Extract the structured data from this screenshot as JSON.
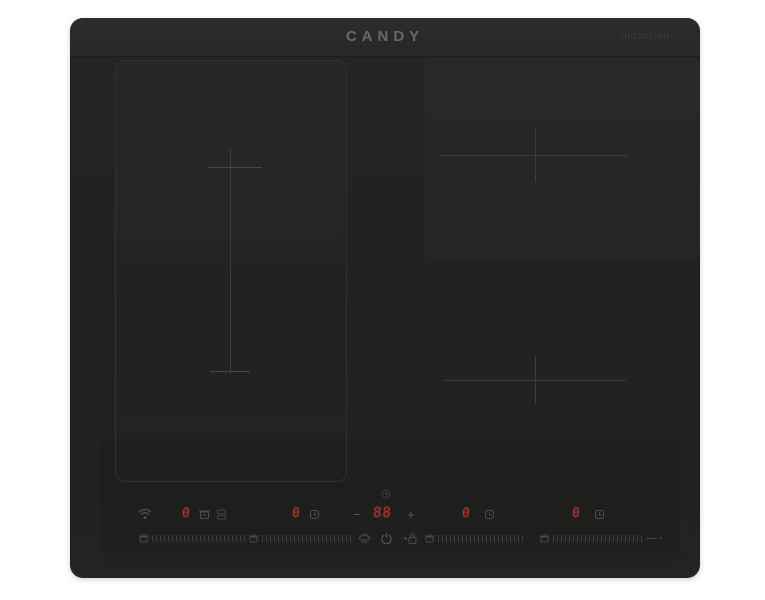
{
  "brand": {
    "logo_text": "CANDY",
    "tagline": "induction"
  },
  "control_panel": {
    "zones": [
      {
        "name": "left-front",
        "level": "0"
      },
      {
        "name": "left-rear",
        "level": "0"
      },
      {
        "name": "right-rear",
        "level": "0"
      },
      {
        "name": "right-front",
        "level": "0"
      }
    ],
    "timer": {
      "value": "88",
      "minus_label": "−",
      "plus_label": "+"
    },
    "icons": {
      "wifi": "wifi-icon",
      "pot_detect": "pot-icon",
      "bridge_zone": "bridge-zone-icon",
      "timer_clock": "clock-icon",
      "special_functions": "chef-hat-icon",
      "power": "power-icon",
      "child_lock": "lock-icon",
      "zone_slider": "pan-icon"
    }
  },
  "colors": {
    "digit_red": "#b13631",
    "surface_black": "#232321",
    "bezel_gray": "#2b2b29",
    "marking_gray": "#3d3d3b",
    "tick_gray": "#45453f",
    "logo_gray": "#6a6a66"
  }
}
